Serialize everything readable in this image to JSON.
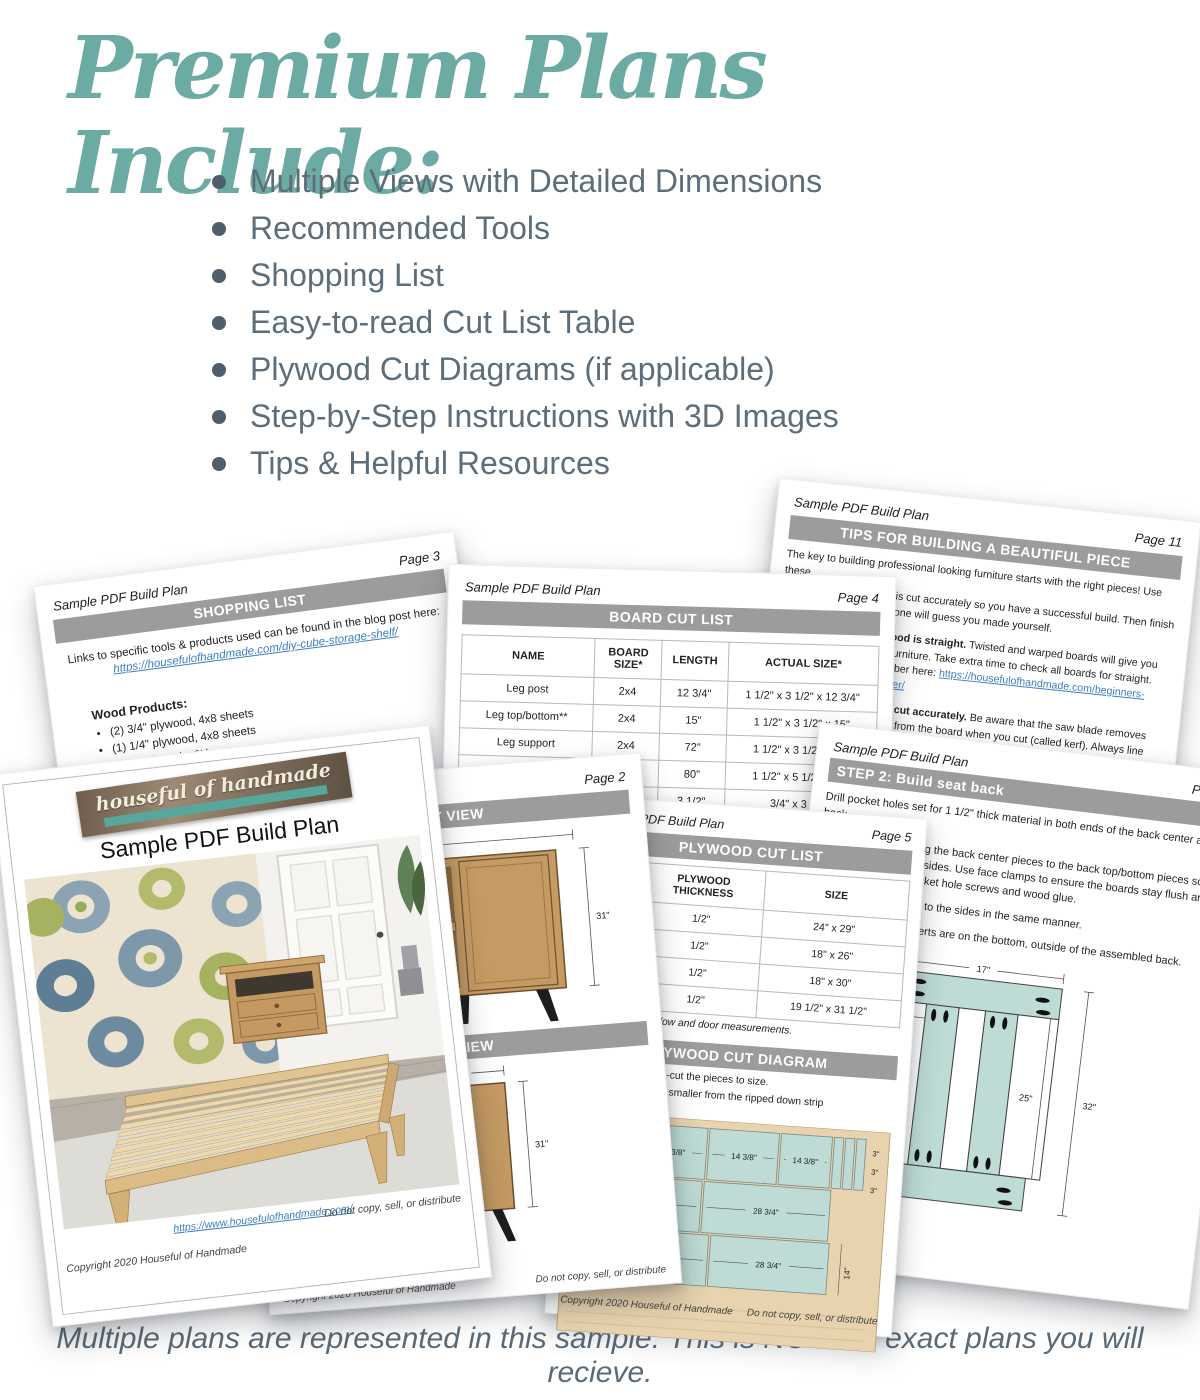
{
  "header": {
    "title": "Premium Plans Include:",
    "features": [
      "Multiple Views with Detailed Dimensions",
      "Recommended Tools",
      "Shopping List",
      "Easy-to-read Cut List Table",
      "Plywood Cut Diagrams (if applicable)",
      "Step-by-Step Instructions with 3D Images",
      "Tips & Helpful Resources"
    ]
  },
  "caption": "Multiple plans are represented in this sample. This is NOT the exact plans you will recieve.",
  "colors": {
    "accent_teal": "#6CABA3",
    "slate_text": "#5d6d79",
    "bar_gray": "#9c9c9c",
    "link_blue": "#3E7EC1",
    "diagram_teal": "#BEDBD5",
    "plywood_tan": "#E7D3AE"
  },
  "pages": {
    "cover": {
      "logo_text": "houseful of handmade",
      "title": "Sample PDF Build Plan",
      "link": "https://www.housefulofhandmade.com/",
      "copyright": "Copyright 2020 Houseful of Handmade",
      "notice": "Do not copy, sell, or distribute"
    },
    "page2": {
      "plan_title": "Sample PDF Build Plan",
      "page_label": "Page 2",
      "front_bar": "FRONT VIEW",
      "side_bar": "SIDE VIEW",
      "front_dims": {
        "top": "5 1/4\"",
        "right": "31\"",
        "left_a": "1/4\"",
        "left_b": "4\""
      },
      "side_dims": {
        "top": "15\"",
        "right": "31\""
      },
      "copyright": "Copyright 2020 Houseful of Handmade",
      "notice": "Do not copy, sell, or distribute"
    },
    "page3": {
      "plan_title": "Sample PDF Build Plan",
      "page_label": "Page 3",
      "bar": "SHOPPING LIST",
      "intro": "Links to specific tools & products used can be found in the blog post here:",
      "link": "https://housefulofhandmade.com/diy-cube-storage-shelf/",
      "group_title": "Wood Products:",
      "items": [
        "(2) 3/4\" plywood, 4x8 sheets",
        "(1) 1/4\" plywood, 4x8 sheets",
        "(5) 1x2 boards, 8' long"
      ]
    },
    "page4": {
      "plan_title": "Sample PDF Build Plan",
      "page_label": "Page 4",
      "bar": "BOARD CUT LIST",
      "headers": [
        "NAME",
        "BOARD SIZE*",
        "LENGTH",
        "ACTUAL SIZE*"
      ],
      "rows": [
        [
          "Leg post",
          "2x4",
          "12 3/4\"",
          "1 1/2\" x 3 1/2\" x 12 3/4\""
        ],
        [
          "Leg top/bottom**",
          "2x4",
          "15\"",
          "1 1/2\" x 3 1/2\" x 15\""
        ],
        [
          "Leg support",
          "2x4",
          "72\"",
          "1 1/2\" x 3 1/2\" x 72\""
        ],
        [
          "Seat slats",
          "2x6",
          "80\"",
          "1 1/2\" x 5 1/2\" x 80\""
        ],
        [
          "",
          "x4",
          "3 1/2\"",
          "3/4\" x 3 1/2\""
        ]
      ],
      "footnote": "dimensional"
    },
    "page5": {
      "plan_title": "Sample PDF Build Plan",
      "page_label": "Page 5",
      "bar": "PLYWOOD CUT LIST",
      "headers": [
        "PLYWOOD THICKNESS",
        "SIZE"
      ],
      "rows": [
        [
          "1/2\"",
          "24\" x 29\""
        ],
        [
          "1/2\"",
          "18\" x 26\""
        ],
        [
          "1/2\"",
          "18\" x 30\""
        ],
        [
          "1/2\"",
          "19 1/2\" x 31 1/2\""
        ]
      ],
      "note": "next page for window and door measurements.",
      "diagram_bar": "PLYWOOD CUT DIAGRAM",
      "diagram_line1": "trips first, then cross-cut the pieces to size.",
      "diagram_line2": "need to be cut down smaller from the ripped down strip",
      "diagram_line3": "xact measurements).",
      "pieces_row1": [
        "14\"",
        "14 3/8\"",
        "14 3/8\"",
        "14 3/8\""
      ],
      "pieces_small": [
        "3\"",
        "3\"",
        "3\""
      ],
      "pieces_row2": [
        "28 3/4\"",
        "28 3/4\""
      ],
      "pieces_row3": [
        "30 1/4\"",
        "28 3/4\""
      ],
      "side_dim": "14\"",
      "copyright": "Copyright 2020 Houseful of Handmade",
      "notice": "Do not copy, sell, or distribute"
    },
    "page7": {
      "plan_title": "Sample PDF Build Plan",
      "page_label": "Page 7",
      "bar": "STEP 2: Build seat back",
      "line1": "Drill pocket holes set for 1 1/2\" thick material in both ends of the back center and back",
      "line2": "ing the back center pieces to the back top/bottom pieces so",
      "line3": "e sides. Use face clamps to ensure the boards stay flush and",
      "line4": "ocket hole screws and wood glue.",
      "line5": "es to the sides in the same manner.",
      "line6": "nserts are on the bottom, outside of the assembled back.",
      "dims": {
        "top": "17\"",
        "inset": "4 1/4\"",
        "inner": "25\"",
        "outer": "32\""
      }
    },
    "page11": {
      "plan_title": "Sample PDF Build Plan",
      "page_label": "Page 11",
      "bar": "TIPS FOR BUILDING A BEAUTIFUL PIECE",
      "l1": "The key to building professional looking furniture starts with the right pieces! Use these",
      "l2": "e is cut accurately so you have a successful build. Then finish",
      "l3": "o one will guess you made yourself.",
      "b4": "wood is straight.",
      "t4": " Twisted and warped boards will give you",
      "l5": "d furniture. Take extra time to check all boards for straight.",
      "t6": "umber here: ",
      "link6": "https://housefulofhandmade.com/beginners-",
      "link7": "mber/",
      "b8": "are cut accurately.",
      "t8": " Be aware that the saw blade removes",
      "l9": "ood from the board when you cut (called kerf). Always line",
      "l10": "e up with the line, not the center.",
      "b11": "up your blades so you get straight cuts.",
      "t11": " This will ensure",
      "l12": "uts. Make sure your blades are square to the fence and cut",
      "l13": "ees.",
      "b14": "ore cutting.",
      "t14": " Square off the raw edge of your plywood or",
      "l15": "from the factory perfectly square which"
    }
  }
}
